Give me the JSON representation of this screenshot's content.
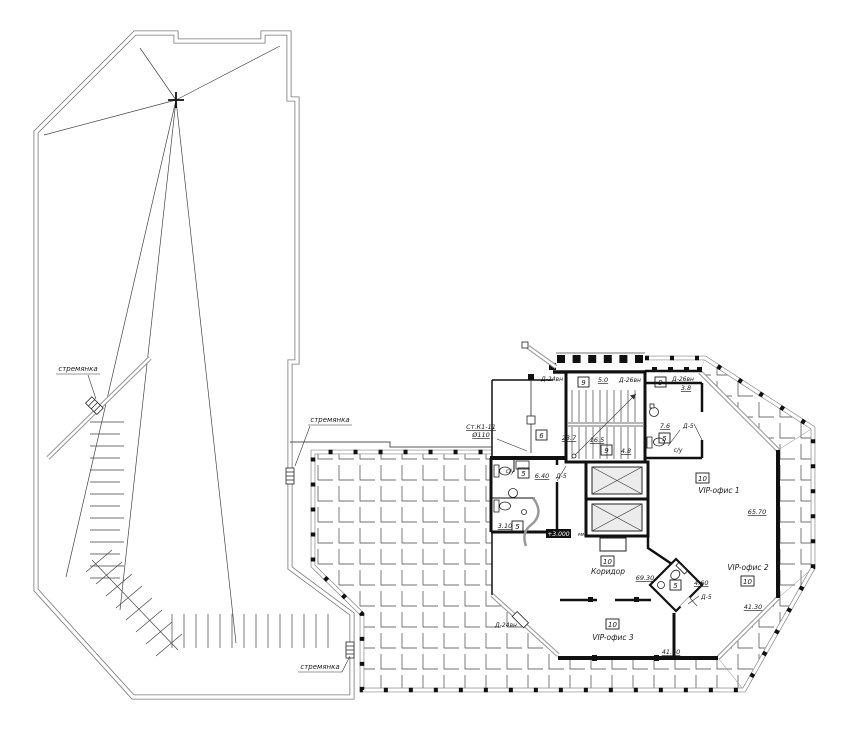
{
  "colors": {
    "ink": "#1a1a1a",
    "glazing": "#999999",
    "tile_line": "#444444"
  },
  "labels": {
    "ladder1": "стремянка",
    "ladder2": "стремянка",
    "ladder3": "стремянка",
    "drain_line1": "Ст.К1-11",
    "drain_line2": "Ø110",
    "door_d24_top": "Д-24вн",
    "door_d26_left": "Д-26вн",
    "door_d26_right": "Д-26вн",
    "dim_5_0": "5.0",
    "dim_3_8": "3.8",
    "balc_left_no": "9",
    "balc_right_no": "9",
    "stair_area": "16.5",
    "stair_no": "9",
    "stair_small_area": "4.8",
    "room6_no": "6",
    "room6_area": "23.7",
    "wc_top_area": "7.6",
    "wc_top_no": "5",
    "wc_top_name": "с/у",
    "door_d5_top": "Д-5",
    "wc_main_name": "с/у",
    "wc_main_no": "5",
    "wc_main_area": "6.40",
    "door_d5_main": "Д-5",
    "wc_main_sub_area": "3.10",
    "wc_main_sub_no": "5",
    "vip1_no": "10",
    "vip1_name": "VIP-офис 1",
    "vip1_area": "65.70",
    "corridor_no": "10",
    "corridor_name": "Коридор",
    "corridor_area": "69.30",
    "wc_diamond_no": "5",
    "wc_diamond_area": "4.60",
    "door_d5_diamond": "Д-5",
    "vip2_name": "VIP-офис 2",
    "vip2_no": "10",
    "vip2_area": "41.30",
    "vip3_no": "10",
    "vip3_name": "VIP-офис 3",
    "vip3_area": "41.60",
    "door_d24_bottom": "Д-24вн",
    "elevation": "+3.000",
    "elevation_units": "мм"
  }
}
